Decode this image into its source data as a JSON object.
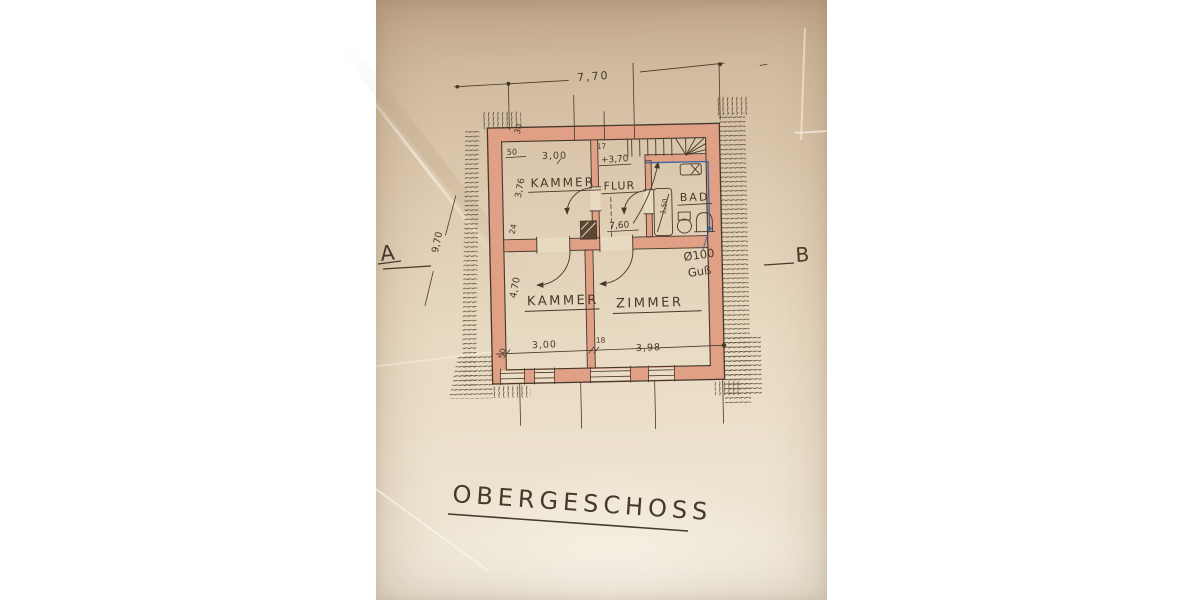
{
  "colors": {
    "paper_top": "#c4a98e",
    "paper_bottom": "#eee6d8",
    "wall_fill": "#dfa086",
    "ink": "#46392a",
    "blue_ink": "#3b67a5"
  },
  "title": {
    "label": "OBERGESCHOSS"
  },
  "section_markers": {
    "left": "A",
    "right": "B"
  },
  "rooms": {
    "kammer_top": {
      "label": "KAMMER"
    },
    "flur": {
      "label": "FLUR"
    },
    "bad": {
      "label": "BAD"
    },
    "kammer_bottom": {
      "label": "KAMMER"
    },
    "zimmer": {
      "label": "ZIMMER"
    }
  },
  "dimensions": {
    "top_width": "7,70",
    "left_total": "9,70",
    "top_wall": "30",
    "top_left_offset": "50",
    "kammer_width": "3,00",
    "kammer_depth": "3,76",
    "left_wall_mid": "24",
    "stair_wall": "17",
    "level_mark": "+3,70",
    "flur_length": "7,60",
    "bath_width": "1,50",
    "lower_depth": "4,70",
    "bottom_left_offset": "50",
    "kammer2_width": "3,00",
    "mid_wall": "18",
    "zimmer_width": "3,98"
  },
  "annotations": {
    "drain_diameter": "Ø100",
    "drain_material": "Guß"
  }
}
